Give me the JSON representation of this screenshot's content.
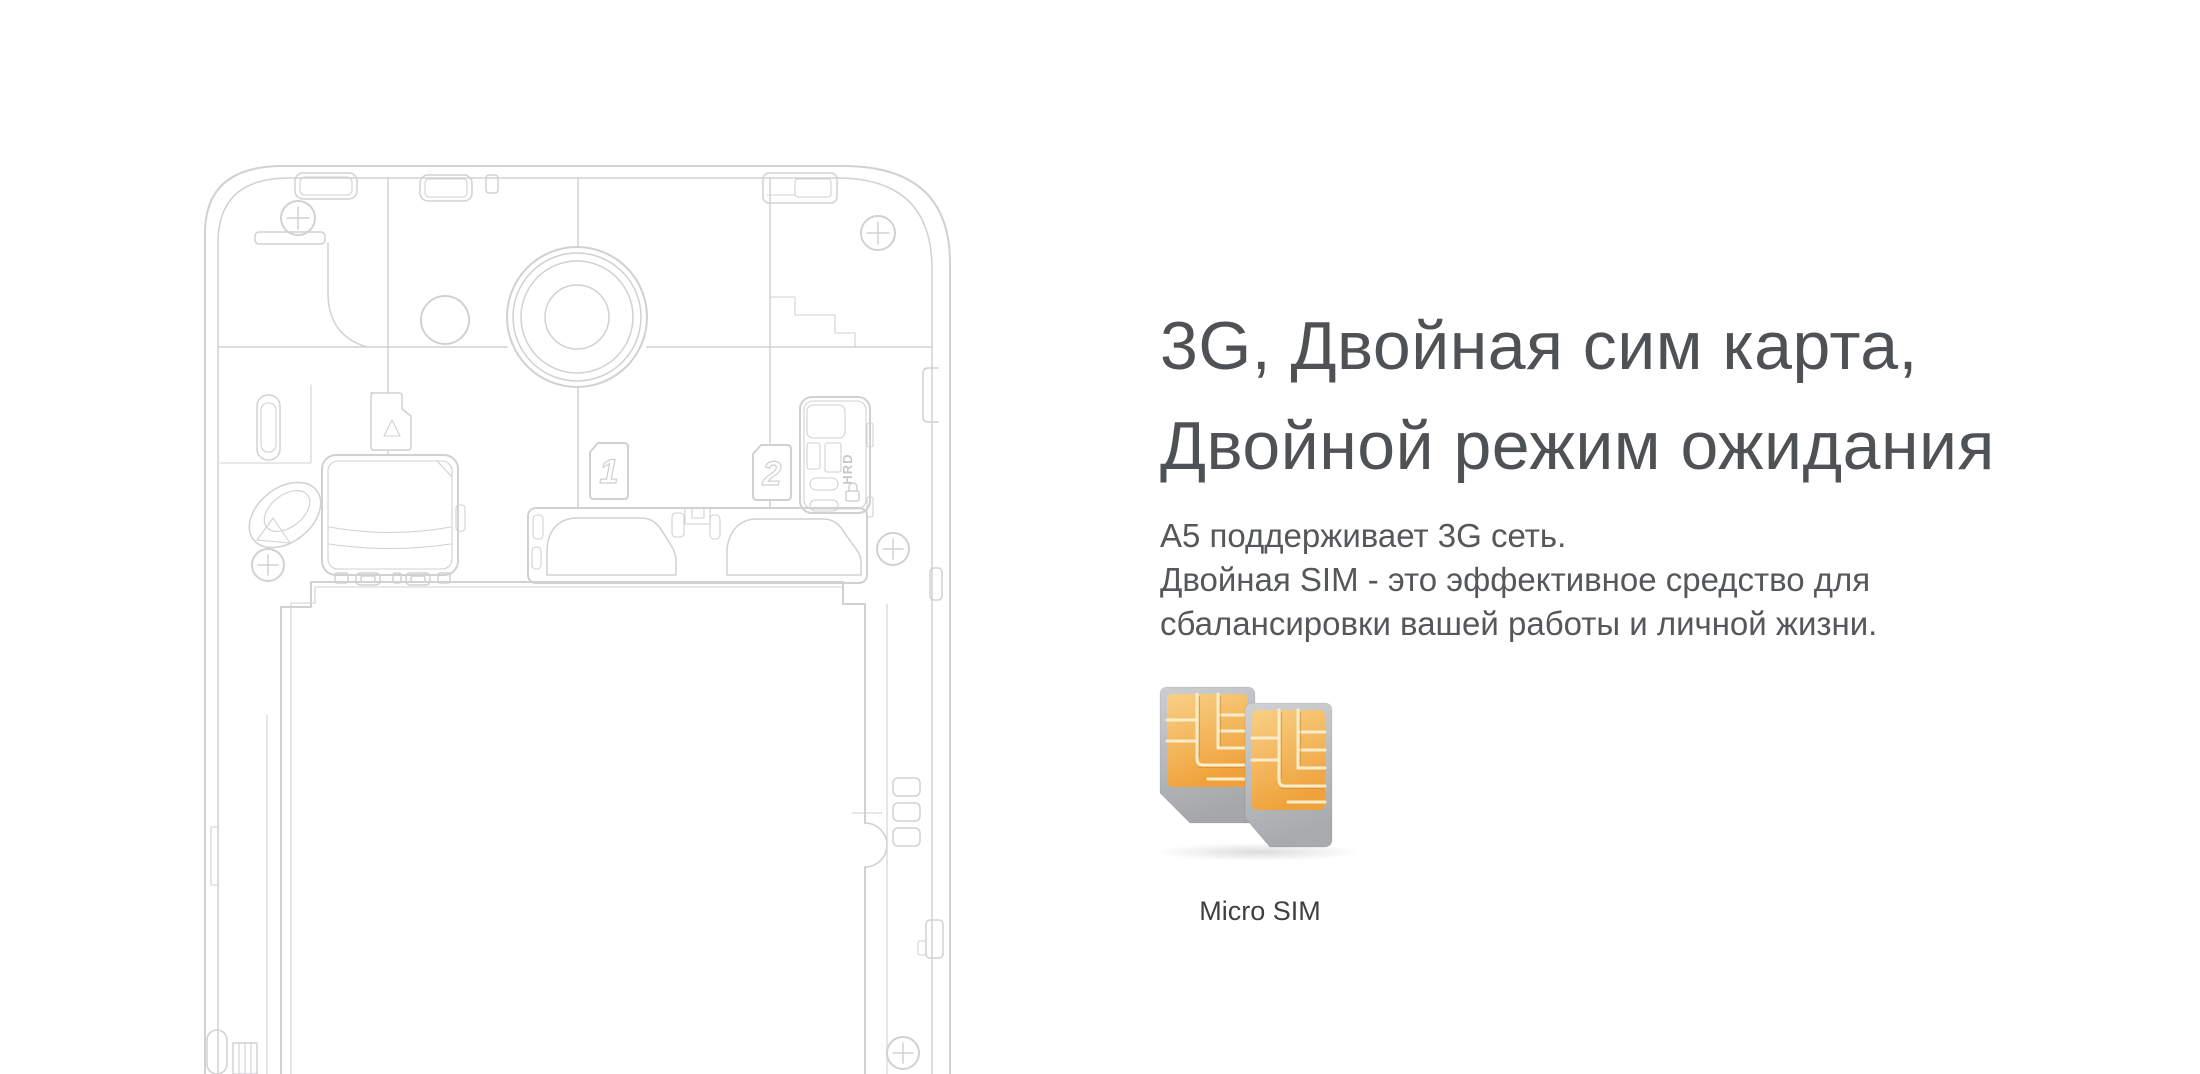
{
  "page": {
    "width": 2200,
    "height": 1074,
    "background": "#ffffff"
  },
  "content": {
    "heading": {
      "line1": "3G, Двойная сим карта,",
      "line2": "Двойной режим ожидания"
    },
    "body": {
      "line1": "A5 поддерживает 3G сеть.",
      "line2": "Двойная SIM - это эффективное средство для",
      "line3": "сбалансировки вашей работы и личной жизни."
    },
    "sim_caption": "Micro SIM"
  },
  "illustration": {
    "sim_slot_1_label": "1",
    "sim_slot_2_label": "2",
    "connector_label": "HRD"
  },
  "colors": {
    "heading_text": "#4f5254",
    "body_text": "#55585a",
    "caption_text": "#3e4041",
    "line_art": "#d2d0d3",
    "sim_gold_light": "#f8d086",
    "sim_gold_dark": "#efa23b",
    "sim_card_light": "#cbcdd0",
    "sim_card_dark": "#a5a8ab"
  }
}
